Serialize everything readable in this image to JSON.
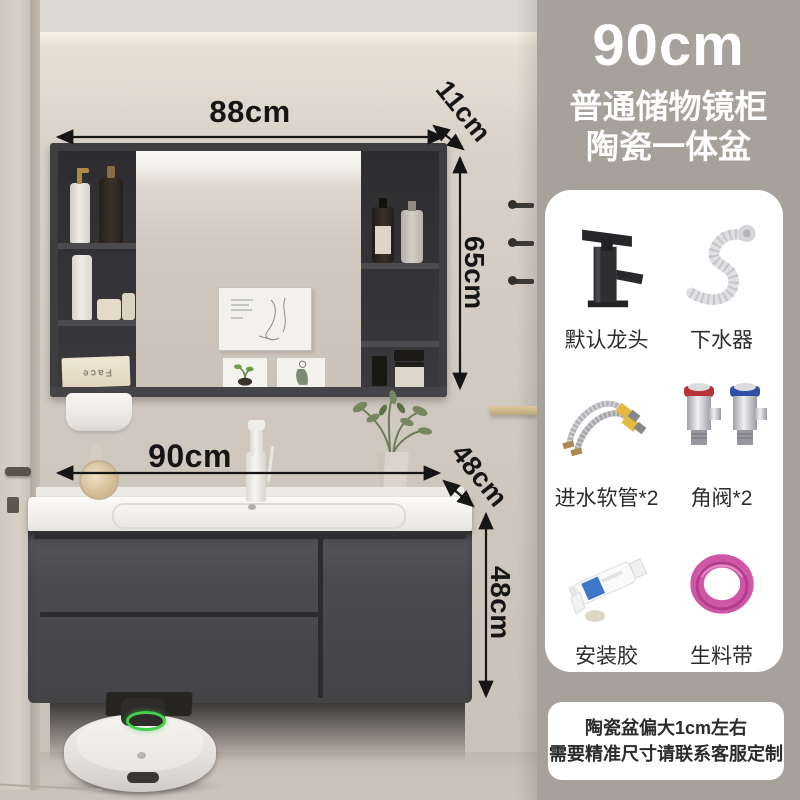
{
  "annotations": {
    "mirror_width": "88cm",
    "mirror_depth": "11cm",
    "mirror_height": "65cm",
    "vanity_width": "90cm",
    "vanity_depth": "48cm",
    "vanity_height": "48cm"
  },
  "info_panel": {
    "size_title": "90cm",
    "subtitle_line1": "普通储物镜柜",
    "subtitle_line2": "陶瓷一体盆",
    "accessories": [
      {
        "name": "default-faucet",
        "label": "默认龙头"
      },
      {
        "name": "drain-kit",
        "label": "下水器"
      },
      {
        "name": "inlet-hoses",
        "label": "进水软管*2"
      },
      {
        "name": "angle-valves",
        "label": "角阀*2"
      },
      {
        "name": "mounting-glue",
        "label": "安装胶"
      },
      {
        "name": "thread-seal-tape",
        "label": "生料带"
      }
    ],
    "note": {
      "line1": "陶瓷盆偏大1cm左右",
      "line2": "需要精准尺寸请联系客服定制"
    }
  },
  "scene": {
    "tissue_box_label": "Face"
  },
  "colors": {
    "side_band": "#a6a19b",
    "cabinet_charcoal": "#4b4b4e",
    "wall_beige": "#d3ccc3",
    "countertop_white": "#f4f3f0",
    "robot_ring_green": "#45d14e",
    "valve_hot_red": "#b73338",
    "valve_cold_blue": "#2f4fa8",
    "tape_pink": "#cf55a6",
    "dimension_text": "#151515"
  }
}
